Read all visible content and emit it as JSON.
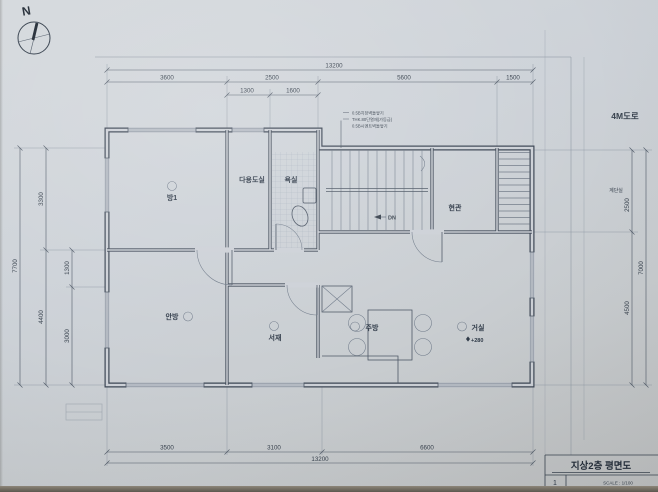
{
  "colors": {
    "paper": "#cdd1d7",
    "ink": "#3c4654",
    "dim": "#4e5866"
  },
  "compass": {
    "label": "N"
  },
  "site": {
    "road_label": "4M도로",
    "stair_hall_label": "계단실"
  },
  "wall_note": {
    "line1": "0.5B치장벽돌쌓기",
    "line2": "THK.80단열재(가등급)",
    "line3": "0.5B시멘트벽돌쌓기"
  },
  "rooms": {
    "room1": "방1",
    "utility": "다용도실",
    "bath": "욕실",
    "entry": "현관",
    "master": "안방",
    "study": "서재",
    "kitchen": "주방",
    "living": "거실"
  },
  "stairs": {
    "down_label": "DN"
  },
  "levels": {
    "living_level": "+280"
  },
  "dimensions": {
    "top": {
      "total": "13200",
      "seg1": "3600",
      "seg2": "2500",
      "seg3": "5600",
      "seg4": "1500",
      "sub1": "1300",
      "sub2": "1600"
    },
    "bottom": {
      "seg1": "3500",
      "seg2": "3100",
      "seg3": "6600",
      "total": "13200"
    },
    "left": {
      "total": "7700",
      "seg1": "3300",
      "seg2": "4400",
      "sub1": "1300",
      "sub2": "3000"
    },
    "right": {
      "seg1": "2500",
      "seg2": "4500",
      "total": "7000"
    }
  },
  "title_block": {
    "title": "지상2층 평면도",
    "sheet_no": "1",
    "scale": "SCALE : 1/100"
  }
}
